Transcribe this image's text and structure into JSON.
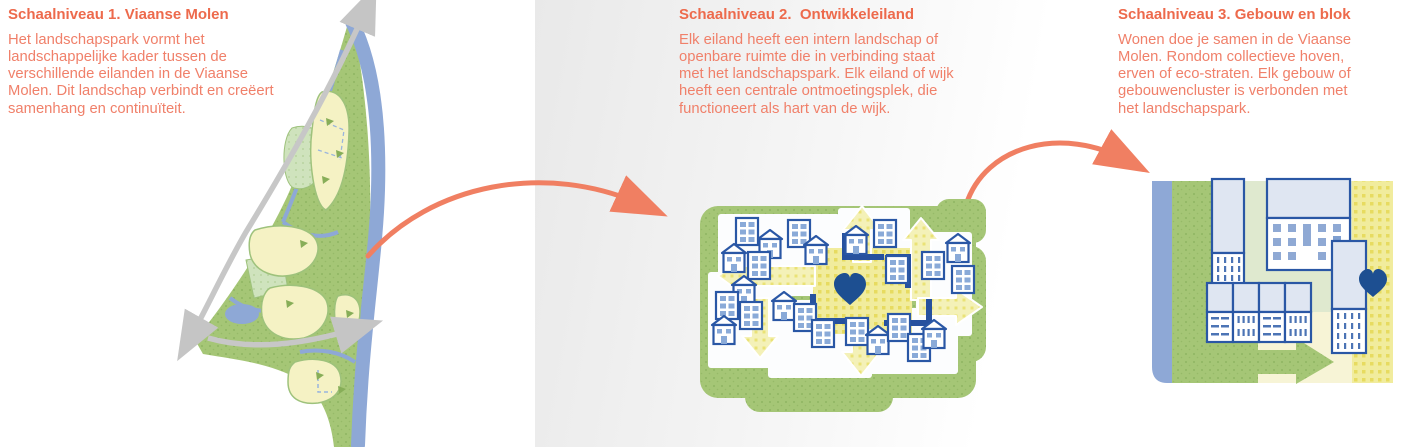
{
  "panels": [
    {
      "title": "Schaalniveau 1. Viaanse Molen",
      "body": "Het landschapspark vormt het landschappelijke kader tussen de verschillende eilanden in de Viaanse Molen. Dit landschap verbindt en creëert samenhang en continuïteit.",
      "illustration": "landscape-park-map"
    },
    {
      "title": "Schaalniveau 2.  Ontwikkeleiland",
      "body": "Elk eiland heeft een intern landschap of openbare ruimte die in verbinding staat met het landschapspark. Elk eiland of wijk heeft een centrale ontmoetingsplek, die functioneert als hart van de wijk.",
      "illustration": "development-island"
    },
    {
      "title": "Schaalniveau 3. Gebouw en blok",
      "body": "Wonen doe je samen in de Viaanse Molen. Rondom collectieve hoven, erven of eco-straten. Elk gebouw of gebouwencluster is verbonden met het landschapspark.",
      "illustration": "building-and-block"
    }
  ],
  "icons": {
    "heart-icon": "♥",
    "house-icon": "⌂",
    "apartment-icon": "▤",
    "curved-arrow-icon": "➜",
    "road-arrow-icon": "➔"
  },
  "colors": {
    "title_orange": "#ed6a4c",
    "body_orange": "#f0806a",
    "connector_orange": "#f07f62",
    "park_green": "#a5c676",
    "park_green_dot": "#8fb562",
    "light_green": "#cfe3bd",
    "panel3_background_green": "#dfe9cf",
    "island_yellow": "#f5f2c4",
    "plaza_yellow": "#f1ec9d",
    "plaza_yellow_dot": "#e7db60",
    "cream": "#f7f4d6",
    "water_blue": "#8ea8d6",
    "building_outline_blue": "#2a57a5",
    "building_fill_light": "#dfe6f2",
    "window_blue": "#8aaad8",
    "heart_blue": "#1d4f91",
    "road_gray": "#c7c7c7",
    "band_gray": "#e9e9e9"
  }
}
